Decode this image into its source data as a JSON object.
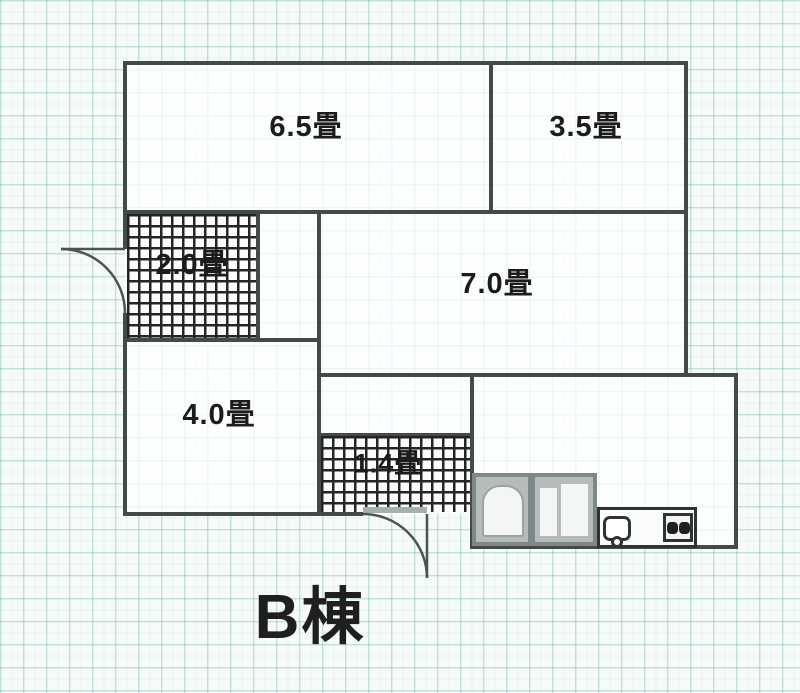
{
  "plan": {
    "building_label": "B棟",
    "rooms": {
      "room_6_5": "6.5畳",
      "room_3_5": "3.5畳",
      "genkan_2_0": "2.0畳",
      "room_7_0": "7.0畳",
      "room_4_0": "4.0畳",
      "hall_1_4": "1.4畳"
    },
    "icons": {
      "door_swing": "quarter-circle-arc",
      "bathtub": "rounded-top-rect",
      "toilet_compartment": "double-rect",
      "sink": "rounded-square-with-faucet-circle",
      "stove": "square-with-two-burner-circles"
    },
    "colors": {
      "wall": "#434a4a",
      "hatch": "#242424",
      "grid": "#8cc4b8",
      "label_text": "#1c1c1c",
      "fixture_gray": "#7f8888"
    }
  }
}
